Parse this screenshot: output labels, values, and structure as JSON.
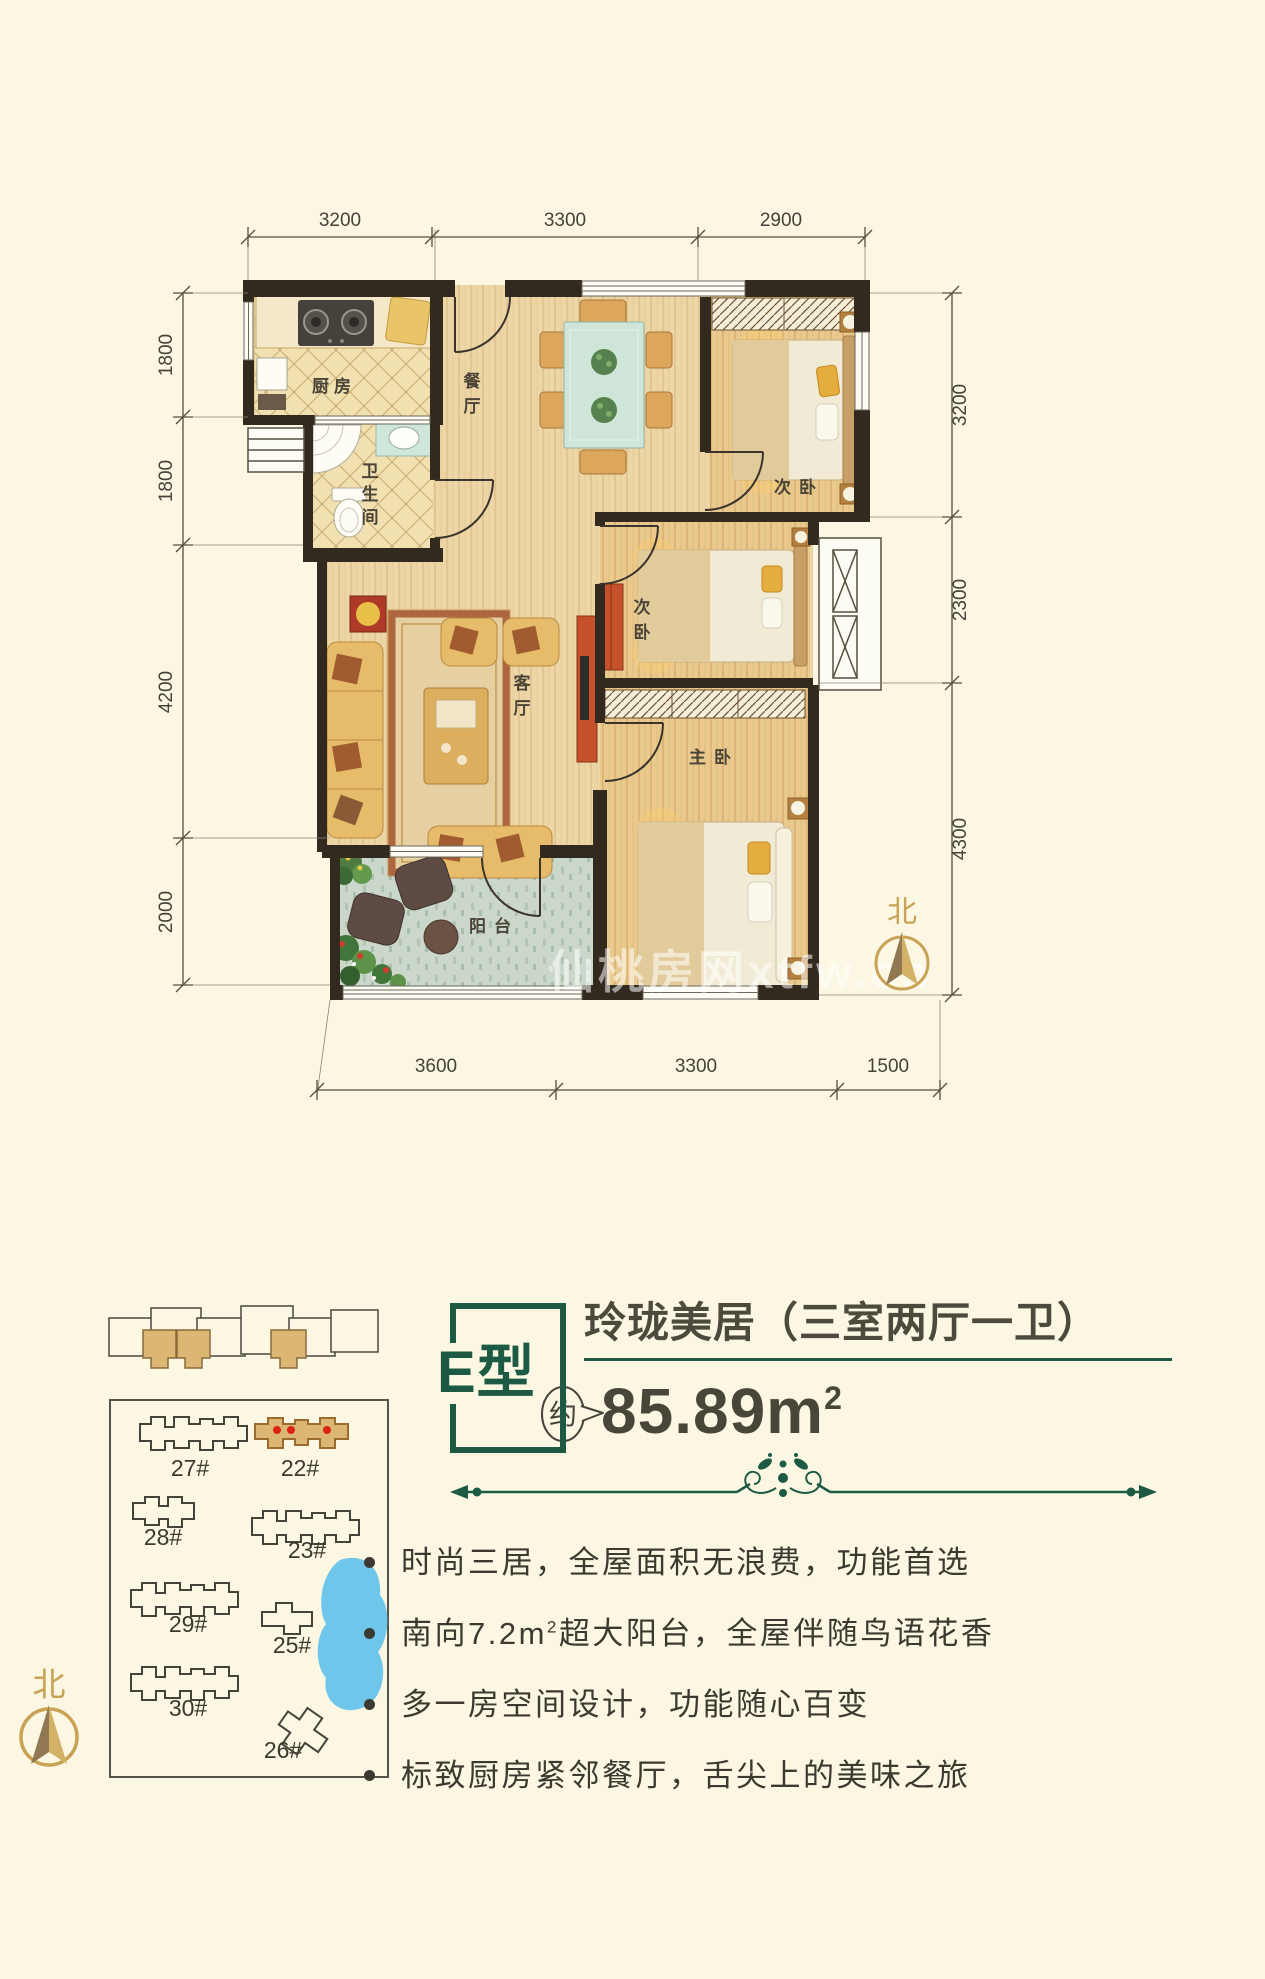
{
  "page": {
    "background": "#fbf7e3",
    "accent_green": "#1d5a43",
    "accent_gold": "#c8a255",
    "text_dark": "#3c3a30",
    "wall_color": "#32291f",
    "highlight_tan": "#dcb673",
    "lake_blue": "#6ec6ea",
    "red_dot": "#dc2212"
  },
  "floor_plan": {
    "north_label": "北",
    "watermark": "仙桃房网xtfw.cn",
    "dimensions": {
      "top": [
        "3200",
        "3300",
        "2900"
      ],
      "bottom": [
        "3600",
        "3300",
        "1500"
      ],
      "left": [
        "1800",
        "1800",
        "4200",
        "2000"
      ],
      "right": [
        "3200",
        "2300",
        "4300"
      ]
    },
    "rooms": {
      "kitchen": "厨房",
      "dining": "餐厅",
      "bath": "卫生间",
      "living": "客厅",
      "bedroom_top": "次卧",
      "bedroom_mid": "次卧",
      "master": "主卧",
      "balcony": "阳台"
    }
  },
  "site_plan": {
    "north_label": "北",
    "buildings": [
      "27#",
      "22#",
      "28#",
      "23#",
      "29#",
      "25#",
      "30#",
      "26#"
    ]
  },
  "info": {
    "type_badge": "E型",
    "title": "玲珑美居（三室两厅一卫）",
    "area_prefix": "约",
    "area_value": "85.89m",
    "area_sup": "2",
    "features": [
      {
        "pre": "时尚三居，全屋面积无浪费，功能首选",
        "sup": "",
        "post": ""
      },
      {
        "pre": "南向7.2m",
        "sup": "2",
        "post": "超大阳台，全屋伴随鸟语花香"
      },
      {
        "pre": "多一房空间设计，功能随心百变",
        "sup": "",
        "post": ""
      },
      {
        "pre": "标致厨房紧邻餐厅，舌尖上的美味之旅",
        "sup": "",
        "post": ""
      }
    ]
  }
}
